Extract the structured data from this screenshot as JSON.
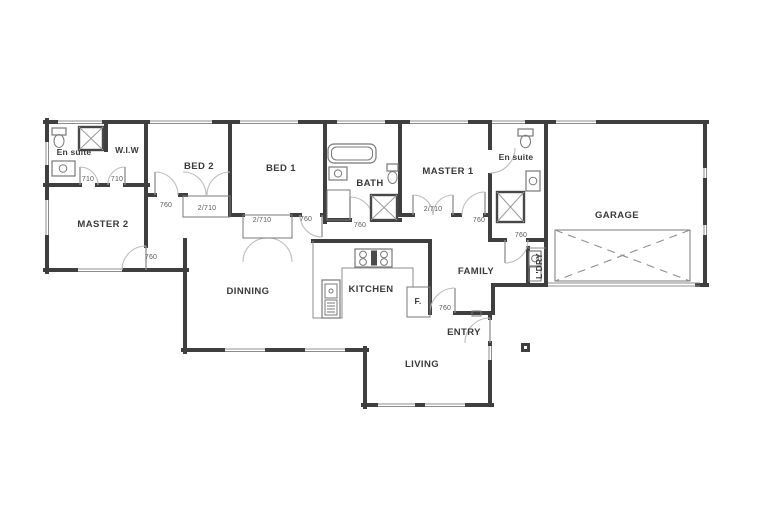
{
  "plan": {
    "rooms": {
      "ensuite_left": "En suite",
      "wiw": "W.I.W",
      "bed2": "BED 2",
      "bed1": "BED 1",
      "bath": "BATH",
      "master1": "MASTER 1",
      "ensuite_right": "En suite",
      "garage": "GARAGE",
      "master2": "MASTER 2",
      "dinning": "DINNING",
      "kitchen": "KITCHEN",
      "family": "FAMILY",
      "laundry": "L'DRY",
      "living": "LIVING",
      "entry": "ENTRY",
      "fridge": "F."
    },
    "door_dimensions": {
      "wiw_left": "710",
      "wiw_right": "710",
      "master2_door": "760",
      "bed2_door": "760",
      "bed2_wardrobe": "2/710",
      "bed1_wardrobe": "2/710",
      "bed1_door": "760",
      "bath_door": "760",
      "master1_door": "2/710",
      "hall_family_door": "760",
      "laundry_door": "760",
      "kitchen_entry_door": "760"
    },
    "colors": {
      "wall": "#3f3f3f",
      "thin": "#8c8c8c",
      "arc": "#bdbdbd",
      "label": "#3a3a3a",
      "dim": "#5a5a5a"
    }
  }
}
